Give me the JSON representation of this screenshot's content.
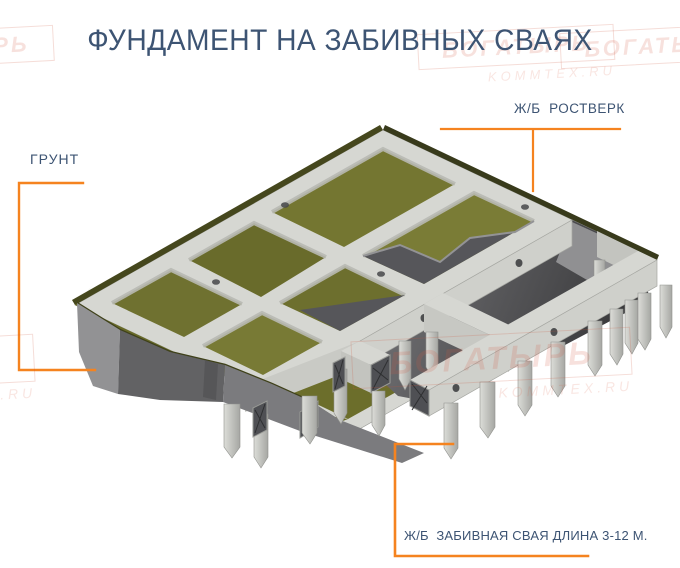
{
  "title": "ФУНДАМЕНТ НА ЗАБИВНЫХ СВАЯХ",
  "callouts": {
    "ground": "ГРУНТ",
    "grillage": "Ж/Б  РОСТВЕРК",
    "pile": "Ж/Б  ЗАБИВНАЯ СВАЯ ДЛИНА 3-12 М."
  },
  "watermark": {
    "name": "БОГАТЫРЬ",
    "site": "KOMMTEX.RU"
  },
  "colors": {
    "title_text": "#3d5473",
    "callout_text": "#3d5473",
    "callout_line": "#f5831f",
    "watermark_red": "#c8684e",
    "grass_top": "#6f7130",
    "grass_edge": "#45471d",
    "concrete_light": "#d6d7d2",
    "concrete_shade": "#c3c4bf",
    "soil_light": "#929294",
    "soil_mid": "#626264",
    "soil_dark": "#38383a",
    "rebar_end": "#4f5054"
  }
}
